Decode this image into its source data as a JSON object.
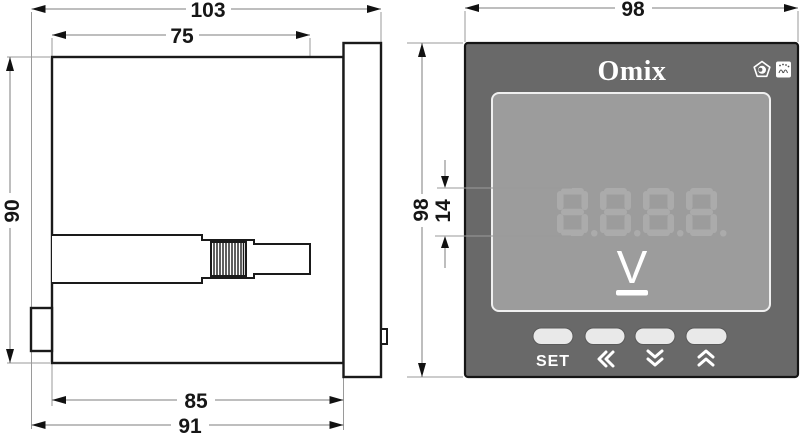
{
  "colors": {
    "bezel": "#696969",
    "display-panel": "#9c9c9c",
    "digit-ghost": "#ababab",
    "button-fill": "#e9e9e9",
    "front-text": "#ffffff",
    "line": "#1a1a1a",
    "dim-line": "#7d7d7d",
    "ext-line": "#9a9a9a"
  },
  "side_view": {
    "dimensions": {
      "overall_depth": "103",
      "depth_behind_panel": "75",
      "case_height": "90",
      "case_depth": "85",
      "depth_with_terminals": "91"
    }
  },
  "front_view": {
    "dimensions": {
      "bezel_width": "98",
      "bezel_height": "98",
      "digit_height": "14"
    },
    "brand": "Omix",
    "display": {
      "digits": [
        "8.",
        "8.",
        "8.",
        "8."
      ],
      "unit": "V"
    },
    "buttons": {
      "set_label": "SET",
      "left_icon": "double-left-chevron",
      "down_icon": "double-down-chevron",
      "up_icon": "double-up-chevron"
    },
    "badges": [
      "eye-pentagon-mark",
      "pattern-badge"
    ]
  }
}
